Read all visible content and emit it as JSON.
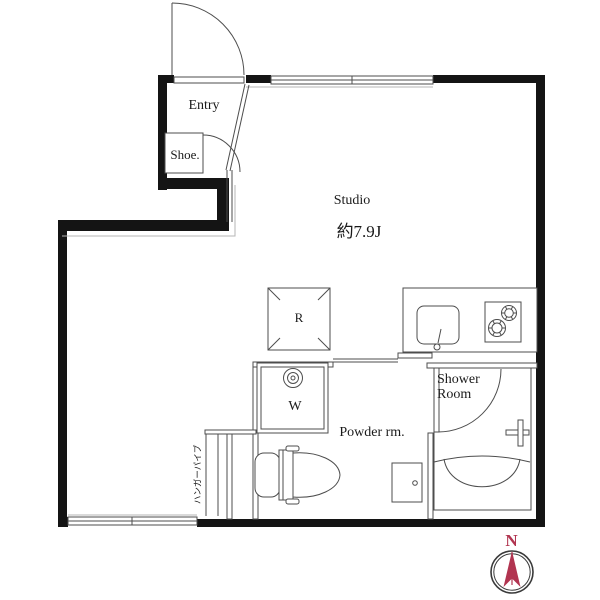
{
  "rooms": {
    "entry": "Entry",
    "shoe": "Shoe.",
    "studio_name": "Studio",
    "studio_area": "約7.9J",
    "powder": "Powder rm.",
    "shower_1": "Shower",
    "shower_2": "Room",
    "closet": "ハンガーパイプ"
  },
  "fixtures": {
    "refrigerator": "R",
    "washer": "W"
  },
  "compass": {
    "north": "N"
  },
  "colors": {
    "wall": "#141414",
    "line": "#4d4d4d",
    "text": "#1a1a1a",
    "compass_red": "#b13450",
    "compass_ring": "#3a3a3a"
  }
}
